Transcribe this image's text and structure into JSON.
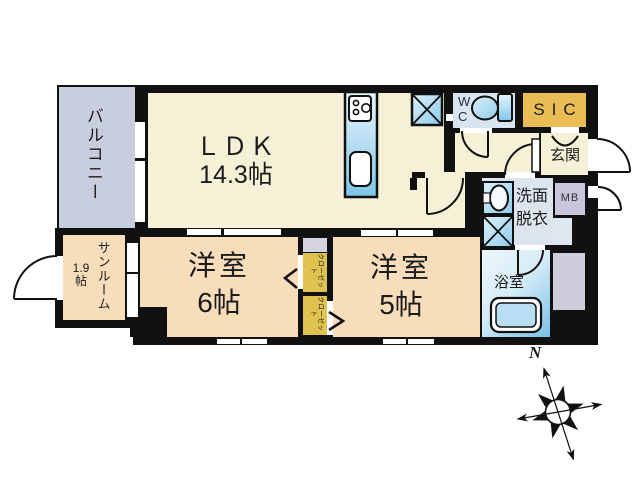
{
  "plan": {
    "title": "apartment-floor-plan",
    "rooms": {
      "balcony": {
        "label": "バルコニー"
      },
      "ldk": {
        "label": "ＬＤＫ",
        "size": "14.3帖"
      },
      "sunroom": {
        "label": "サンルーム",
        "size_line1": "1.9",
        "size_line2": "帖"
      },
      "bedroom6": {
        "label": "洋室",
        "size": "6帖"
      },
      "bedroom5": {
        "label": "洋室",
        "size": "5帖"
      },
      "wc": {
        "label_line1": "W",
        "label_line2": "C"
      },
      "sic": {
        "label": "SIC"
      },
      "genkan": {
        "label": "玄関"
      },
      "mb": {
        "label": "MB"
      },
      "washroom": {
        "label_line1": "洗面",
        "label_line2": "脱衣"
      },
      "bathroom": {
        "label": "浴室"
      },
      "closet_upper": {
        "label": "クローゼット"
      },
      "closet_lower": {
        "label": "クローゼット"
      }
    },
    "compass": {
      "north_label": "N"
    },
    "colors": {
      "wall": "#111111",
      "ldk_cream": "#f4f1d6",
      "bedroom_peach": "#f8ddbb",
      "balcony_gray": "#c9cede",
      "sic_gold": "#e9bc55",
      "closet_yellow": "#dfc24f",
      "wc_blue": "#d6e5f0",
      "washroom_blue": "#dce4ee",
      "mb_lavender": "#cac5db",
      "ps_gray": "#cfccdb",
      "fixture_blue": "#86c8ea"
    }
  }
}
